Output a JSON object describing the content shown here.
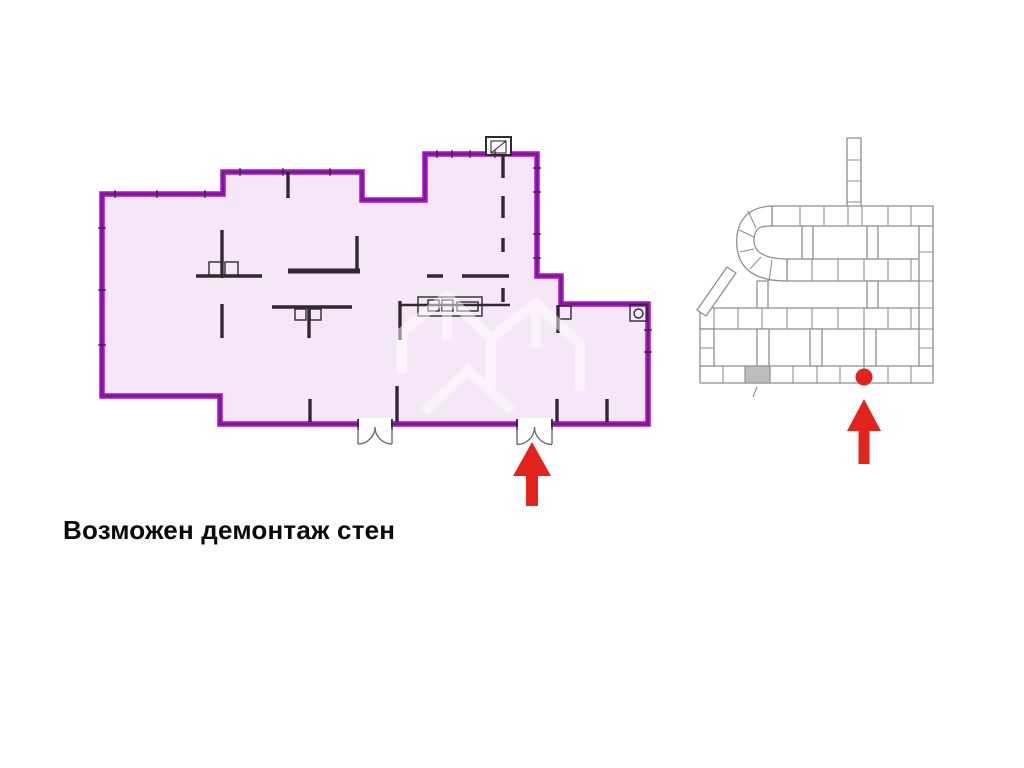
{
  "caption": {
    "text": "Возможен демонтаж стен"
  },
  "colors": {
    "plan_outline": "#a911c9",
    "plan_fill": "#f6e7f8",
    "wall_ink": "#2e2a2e",
    "door_line": "#6e6e6e",
    "accent_red": "#e3241c",
    "site_line": "#8f8f8f",
    "site_fill": "#ffffff",
    "site_shaded": "#bdbdbd",
    "caption_ink": "#0a0a0a",
    "watermark": "#ffffff",
    "page_bg": "#ffffff"
  },
  "icons": {
    "washer_icon": "circle-in-square appliance symbol",
    "door_swing_icon": "double quarter-circle door arcs",
    "entrance_arrow_icon": "red arrow pointing up at entrance door",
    "location_marker_icon": "red dot with red arrow on site plan",
    "shaft_icon": "small hatched shaft box on outer wall"
  }
}
